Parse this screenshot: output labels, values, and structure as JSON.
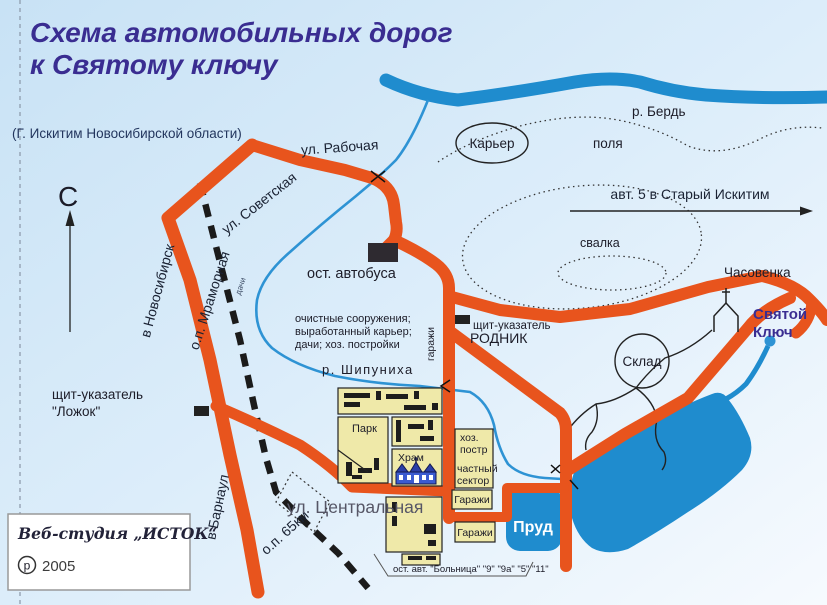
{
  "header": {
    "title_line1": "Схема автомобильных дорог",
    "title_line2": "к Святому ключу",
    "subtitle": "(Г. Искитим Новосибирской области)"
  },
  "north": {
    "letter": "С"
  },
  "waterways": {
    "berd": "р. Бердь",
    "shipunikha": "р. Шипуниха",
    "prud": "Пруд"
  },
  "places": {
    "karier": "Карьер",
    "polya": "поля",
    "svalka": "свалка",
    "sklad": "Склад",
    "chasovenka": "Часовенка",
    "svyatoy_line1": "Святой",
    "svyatoy_line2": "Ключ"
  },
  "streets": {
    "rabochaya": "ул. Рабочая",
    "sovetskaya": "ул. Советская",
    "centralnaya": "ул. Центральная",
    "novosibirsk": "в Новосибирск",
    "barnaul": "в Барнаул",
    "mramornaya": "о.п. Мраморная",
    "km65": "о.п. 65км",
    "avt5": "авт. 5 в Старый Искитим"
  },
  "stops": {
    "avtobusa": "ост. автобуса",
    "bolnitsa": "ост. авт. \"Больница\" \"9\" \"9а\" \"5\" \"11\"",
    "dachi": "дачи"
  },
  "signs": {
    "rodnik_label": "щит-указатель",
    "rodnik_name": "РОДНИК",
    "lozhok_label": "щит-указатель",
    "lozhok_name": "\"Ложок\""
  },
  "blocks": {
    "park": "Парк",
    "khram": "Храм",
    "khoz_line1": "хоз.",
    "khoz_line2": "постр",
    "chastny_line1": "частный",
    "chastny_line2": "сектор",
    "garazhi_vertical": "гаражи",
    "garazhi1": "Гаражи",
    "garazhi2": "Гаражи"
  },
  "notes": {
    "ochistnye_line1": "очистные сооружения;",
    "ochistnye_line2": "выработанный карьер;",
    "ochistnye_line3": "дачи; хоз. постройки"
  },
  "logo": {
    "studio": "Веб-студия „ИСТОК“",
    "p_mark": "р",
    "year": "2005"
  },
  "colors": {
    "road": "#E8541D",
    "water": "#1F8CCE",
    "block_fill": "#EFE9A9",
    "title": "#3A2D91",
    "background_top": "#C8E2F5",
    "background_bottom": "#F6FAFE"
  }
}
